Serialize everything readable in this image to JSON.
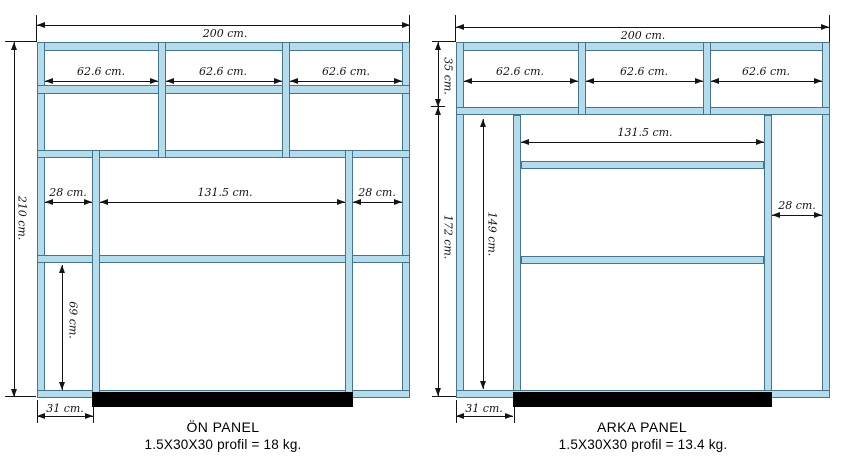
{
  "left_panel": {
    "title": "ÖN PANEL",
    "subtitle": "1.5X30X30 profil = 18 kg.",
    "dims": {
      "total_width": "200 cm.",
      "total_height": "210 cm.",
      "top_cell_1": "62.6 cm.",
      "top_cell_2": "62.6 cm.",
      "top_cell_3": "62.6 cm.",
      "mid_left": "28 cm.",
      "mid_center": "131.5 cm.",
      "mid_right": "28 cm.",
      "lower_height": "69 cm.",
      "base_offset": "31 cm."
    }
  },
  "right_panel": {
    "title": "ARKA PANEL",
    "subtitle": "1.5X30X30 profil = 13.4 kg.",
    "dims": {
      "total_width": "200 cm.",
      "top_height": "35 cm.",
      "body_height": "172 cm.",
      "inner_height": "149 cm.",
      "top_cell_1": "62.6 cm.",
      "top_cell_2": "62.6 cm.",
      "top_cell_3": "62.6 cm.",
      "mid_span": "131.5 cm.",
      "right_col": "28 cm.",
      "base_offset": "31 cm."
    }
  },
  "colors": {
    "profile_fill": "#b6dbeb",
    "profile_stroke": "#44758d",
    "dimension_line": "#141414",
    "base_bar": "#000000"
  }
}
